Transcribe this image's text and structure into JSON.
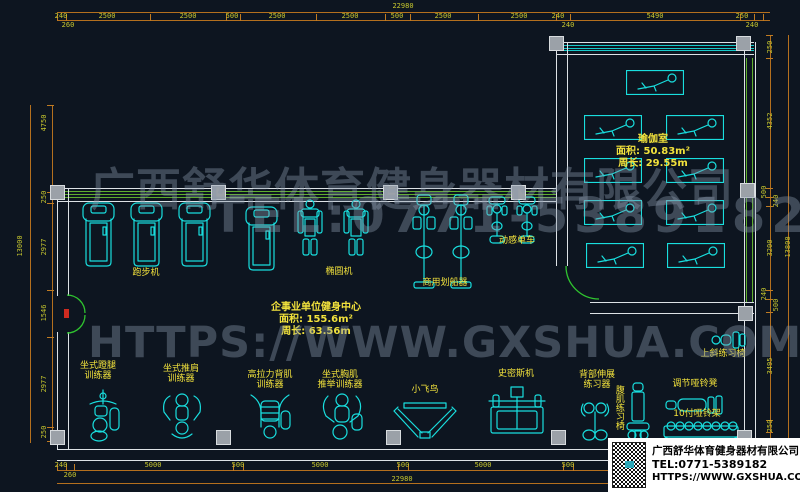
{
  "watermark": {
    "company": "广西舒华体育健身器材有限公司",
    "tel": "TEL:0771-5389182",
    "website": "HTTPS://WWW.GXSHUA.COM"
  },
  "company_box": {
    "name": "广西舒华体育健身器材有限公司",
    "tel": "TEL:0771-5389182",
    "website": "HTTPS://WWW.GXSHUA.COM"
  },
  "rooms": {
    "gym": {
      "name": "企事业单位健身中心",
      "area": "面积: 155.6m²",
      "perimeter": "周长: 63.56m"
    },
    "yoga": {
      "name": "瑜伽室",
      "area": "面积: 50.83m²",
      "perimeter": "周长: 29.55m"
    }
  },
  "labels": {
    "treadmill": "跑步机",
    "elliptical": "椭圆机",
    "rower": "商用划船器",
    "spin_bike": "动感单车",
    "leg_press": "坐式蹬腿\n训练器",
    "shoulder_press": "坐式推肩\n训练器",
    "lat_pull": "高拉力背肌\n训练器",
    "chest_press": "坐式胸肌\n推举训练器",
    "fly_bird": "小飞鸟",
    "smith": "史密斯机",
    "back_ext": "背部伸展\n练习器",
    "ab_chair": "腹肌练习椅",
    "adj_bench": "调节哑铃凳",
    "dumbbell_rack": "10付哑铃架",
    "incline_chair": "上斜练习椅"
  },
  "dims": {
    "top_total": "22980",
    "top": [
      "240",
      "2500",
      "2500",
      "500",
      "2500",
      "2500",
      "500",
      "2500",
      "2500",
      "240",
      "240",
      "5490",
      "250",
      "240",
      "260"
    ],
    "bottom_total": "22980",
    "bottom": [
      "240",
      "260",
      "5000",
      "500",
      "5000",
      "500",
      "5000",
      "500"
    ],
    "left_total": "13000",
    "left": [
      "4750",
      "250",
      "2977",
      "1546",
      "2977",
      "250"
    ],
    "right_total": "13800",
    "right": [
      "250",
      "4352",
      "500",
      "240",
      "3200",
      "240",
      "500",
      "3495",
      "250"
    ]
  },
  "colors": {
    "background": "#0d1520",
    "drawing_cyan": "#19dede",
    "label_yellow": "#f2e23c",
    "dimension_line": "#b4701e",
    "dimension_text": "#c6c62e",
    "wall_white": "#dde2e6",
    "window_green": "#5fae2e",
    "door_green": "#2fc42f",
    "column_gray": "#9ba1a8",
    "door_marker_red": "#cf2b20",
    "watermark_gray": "#8a98aa"
  }
}
